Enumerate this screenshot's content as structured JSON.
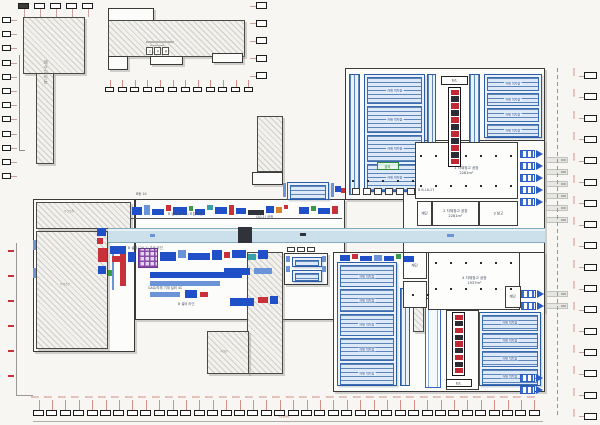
{
  "drawing": {
    "type": "factory-floorplan",
    "sheet_bg": "#f7f6f3"
  },
  "palette": {
    "B": "#2050c8",
    "b": "#6a93d8",
    "R": "#c8303a",
    "G": "#3a9a4a",
    "T": "#38a0a8",
    "D": "#30343a",
    "O": "#d8822f",
    "W": "#ffffff",
    "grayline": "#b8b8b2"
  },
  "labels": {
    "dim": "8000",
    "dim_total": "72000",
    "elevator": "E/L",
    "top_center_code": "208"
  },
  "buildings": [
    {
      "cls": "hatch",
      "x": 23,
      "y": 17,
      "w": 62,
      "h": 57
    },
    {
      "cls": "hatch",
      "x": 36,
      "y": 73,
      "w": 18,
      "h": 91
    },
    {
      "cls": "bldg",
      "x": 108,
      "y": 8,
      "w": 46,
      "h": 13
    },
    {
      "cls": "hatch",
      "x": 108,
      "y": 20,
      "w": 137,
      "h": 37
    },
    {
      "cls": "bldg",
      "x": 108,
      "y": 56,
      "w": 20,
      "h": 14
    },
    {
      "cls": "bldg",
      "x": 150,
      "y": 56,
      "w": 33,
      "h": 9
    },
    {
      "cls": "bldg",
      "x": 212,
      "y": 53,
      "w": 31,
      "h": 10
    },
    {
      "cls": "hatch",
      "x": 257,
      "y": 116,
      "w": 26,
      "h": 56
    },
    {
      "cls": "bldg",
      "x": 252,
      "y": 172,
      "w": 31,
      "h": 13
    },
    {
      "cls": "bldg",
      "x": 33,
      "y": 199,
      "w": 102,
      "h": 153
    },
    {
      "cls": "hatch",
      "x": 36,
      "y": 202,
      "w": 95,
      "h": 27
    },
    {
      "cls": "hatch",
      "x": 36,
      "y": 231,
      "w": 72,
      "h": 118
    },
    {
      "cls": "bldg",
      "x": 135,
      "y": 199,
      "w": 210,
      "h": 121
    },
    {
      "cls": "bldg",
      "x": 345,
      "y": 68,
      "w": 200,
      "h": 132
    },
    {
      "cls": "bldg",
      "x": 403,
      "y": 140,
      "w": 142,
      "h": 172
    },
    {
      "cls": "bldg",
      "x": 333,
      "y": 252,
      "w": 212,
      "h": 140
    },
    {
      "cls": "hatch",
      "x": 247,
      "y": 252,
      "w": 36,
      "h": 122
    },
    {
      "cls": "hatch",
      "x": 207,
      "y": 331,
      "w": 42,
      "h": 43
    },
    {
      "cls": "bldg",
      "x": 284,
      "y": 253,
      "w": 44,
      "h": 32
    },
    {
      "cls": "hatch",
      "x": 413,
      "y": 300,
      "w": 11,
      "h": 32
    }
  ],
  "rack_areas": [
    {
      "x": 364,
      "y": 74,
      "w": 61,
      "h": 118,
      "n": 4,
      "l1": "자재 적치장",
      "l2": "363m²"
    },
    {
      "x": 484,
      "y": 74,
      "w": 58,
      "h": 64,
      "n": 4,
      "l1": "자재 적치장",
      "l2": "363m²"
    },
    {
      "x": 337,
      "y": 262,
      "w": 60,
      "h": 124,
      "n": 5,
      "l1": "자재 적치장",
      "l2": "363m²"
    },
    {
      "x": 479,
      "y": 312,
      "w": 62,
      "h": 74,
      "n": 4,
      "l1": "자재 적치장",
      "l2": "363m²"
    },
    {
      "x": 287,
      "y": 182,
      "w": 42,
      "h": 18,
      "n": 1,
      "l1": "",
      "l2": ""
    },
    {
      "x": 292,
      "y": 257,
      "w": 30,
      "h": 10,
      "n": 1,
      "l1": "",
      "l2": ""
    },
    {
      "x": 292,
      "y": 270,
      "w": 30,
      "h": 12,
      "n": 1,
      "l1": "",
      "l2": ""
    }
  ],
  "channels": [
    {
      "x": 349,
      "y": 74,
      "w": 11,
      "h": 121,
      "double": false
    },
    {
      "x": 427,
      "y": 74,
      "w": 9,
      "h": 121,
      "double": false
    },
    {
      "x": 469,
      "y": 74,
      "w": 11,
      "h": 121,
      "double": false
    },
    {
      "x": 400,
      "y": 288,
      "w": 10,
      "h": 98,
      "double": false
    },
    {
      "x": 425,
      "y": 298,
      "w": 16,
      "h": 90,
      "double": true
    }
  ],
  "rooms": [
    {
      "x": 415,
      "y": 142,
      "w": 103,
      "h": 57,
      "lines": [
        "1 자재창고 공장",
        "2281m²"
      ]
    },
    {
      "x": 417,
      "y": 201,
      "w": 15,
      "h": 25,
      "lines": [
        "계단"
      ]
    },
    {
      "x": 432,
      "y": 201,
      "w": 47,
      "h": 25,
      "lines": [
        "2 자재창고 공장",
        "2281m²"
      ]
    },
    {
      "x": 479,
      "y": 201,
      "w": 39,
      "h": 25,
      "lines": [
        "3 창고"
      ]
    },
    {
      "x": 428,
      "y": 252,
      "w": 92,
      "h": 58,
      "lines": [
        "4 자재창고 공장",
        "1937m²"
      ]
    },
    {
      "x": 403,
      "y": 252,
      "w": 24,
      "h": 27,
      "lines": [
        "계단"
      ]
    },
    {
      "x": 403,
      "y": 281,
      "w": 24,
      "h": 27,
      "lines": []
    },
    {
      "x": 505,
      "y": 286,
      "w": 16,
      "h": 22,
      "lines": [
        "계단"
      ]
    },
    {
      "x": 446,
      "y": 310,
      "w": 33,
      "h": 80,
      "lines": []
    }
  ],
  "towers": [
    {
      "x": 448,
      "y": 87,
      "w": 13,
      "h": 80,
      "cells": 11,
      "label": {
        "x": 441,
        "y": 76,
        "w": 27,
        "h": 9
      }
    },
    {
      "x": 452,
      "y": 312,
      "w": 13,
      "h": 64,
      "cells": 9,
      "label": {
        "x": 446,
        "y": 379,
        "w": 26,
        "h": 8
      }
    }
  ],
  "docks": [
    {
      "x": 520,
      "y": 150
    },
    {
      "x": 520,
      "y": 162
    },
    {
      "x": 520,
      "y": 174
    },
    {
      "x": 520,
      "y": 186
    },
    {
      "x": 520,
      "y": 198
    },
    {
      "x": 521,
      "y": 290
    },
    {
      "x": 521,
      "y": 302
    },
    {
      "x": 520,
      "y": 374
    },
    {
      "x": 520,
      "y": 386
    }
  ],
  "gray_tags": [
    {
      "x": 546,
      "y": 157
    },
    {
      "x": 546,
      "y": 169
    },
    {
      "x": 546,
      "y": 181
    },
    {
      "x": 546,
      "y": 193
    },
    {
      "x": 546,
      "y": 205
    },
    {
      "x": 546,
      "y": 217
    },
    {
      "x": 546,
      "y": 291
    },
    {
      "x": 546,
      "y": 303
    }
  ],
  "dot_rows": [
    {
      "x": 420,
      "y": 155,
      "w": 92
    },
    {
      "x": 420,
      "y": 185,
      "w": 92
    },
    {
      "x": 352,
      "y": 180,
      "w": 70
    },
    {
      "x": 435,
      "y": 262,
      "w": 80
    },
    {
      "x": 435,
      "y": 288,
      "w": 80
    },
    {
      "x": 412,
      "y": 294,
      "w": 18
    }
  ],
  "conveyor": {
    "x": 108,
    "y": 228,
    "w": 437,
    "h": 15
  },
  "machines": [
    [
      132,
      207,
      10,
      8,
      "B"
    ],
    [
      144,
      205,
      6,
      10,
      "b"
    ],
    [
      152,
      209,
      12,
      6,
      "B"
    ],
    [
      166,
      205,
      5,
      6,
      "R"
    ],
    [
      173,
      207,
      14,
      8,
      "B"
    ],
    [
      189,
      206,
      4,
      5,
      "G"
    ],
    [
      195,
      209,
      10,
      6,
      "B"
    ],
    [
      207,
      205,
      6,
      5,
      "T"
    ],
    [
      215,
      207,
      12,
      7,
      "B"
    ],
    [
      229,
      205,
      5,
      10,
      "R"
    ],
    [
      236,
      208,
      10,
      6,
      "B"
    ],
    [
      248,
      210,
      16,
      5,
      "D"
    ],
    [
      266,
      206,
      8,
      7,
      "B"
    ],
    [
      276,
      207,
      6,
      6,
      "O"
    ],
    [
      284,
      205,
      4,
      4,
      "R"
    ],
    [
      299,
      207,
      10,
      7,
      "B"
    ],
    [
      311,
      206,
      5,
      5,
      "G"
    ],
    [
      318,
      208,
      12,
      6,
      "B"
    ],
    [
      332,
      206,
      6,
      8,
      "R"
    ],
    [
      283,
      183,
      3,
      14,
      "b"
    ],
    [
      331,
      183,
      3,
      14,
      "b"
    ],
    [
      335,
      186,
      6,
      6,
      "B"
    ],
    [
      341,
      188,
      4,
      5,
      "R"
    ],
    [
      138,
      248,
      20,
      20,
      "grid"
    ],
    [
      120,
      250,
      6,
      36,
      "R"
    ],
    [
      128,
      252,
      7,
      10,
      "B"
    ],
    [
      160,
      252,
      16,
      9,
      "B"
    ],
    [
      178,
      250,
      8,
      8,
      "b"
    ],
    [
      188,
      253,
      22,
      7,
      "B"
    ],
    [
      212,
      250,
      10,
      10,
      "B"
    ],
    [
      224,
      252,
      6,
      6,
      "R"
    ],
    [
      232,
      250,
      14,
      8,
      "B"
    ],
    [
      248,
      254,
      8,
      6,
      "T"
    ],
    [
      258,
      250,
      10,
      9,
      "B"
    ],
    [
      150,
      272,
      92,
      6,
      "B"
    ],
    [
      150,
      281,
      70,
      5,
      "b"
    ],
    [
      98,
      248,
      9,
      14,
      "R"
    ],
    [
      98,
      266,
      8,
      8,
      "B"
    ],
    [
      108,
      270,
      6,
      6,
      "G"
    ],
    [
      224,
      268,
      26,
      7,
      "B"
    ],
    [
      254,
      268,
      18,
      6,
      "b"
    ],
    [
      150,
      292,
      30,
      5,
      "b"
    ],
    [
      185,
      290,
      12,
      8,
      "B"
    ],
    [
      200,
      292,
      8,
      5,
      "R"
    ],
    [
      230,
      298,
      24,
      8,
      "B"
    ],
    [
      258,
      297,
      10,
      6,
      "R"
    ],
    [
      270,
      296,
      8,
      8,
      "B"
    ],
    [
      112,
      246,
      2,
      44,
      "b"
    ],
    [
      110,
      246,
      16,
      8,
      "B"
    ],
    [
      112,
      256,
      10,
      6,
      "R"
    ],
    [
      97,
      228,
      9,
      8,
      "B"
    ],
    [
      97,
      238,
      6,
      6,
      "R"
    ],
    [
      340,
      255,
      10,
      6,
      "B"
    ],
    [
      352,
      254,
      6,
      5,
      "R"
    ],
    [
      360,
      256,
      12,
      5,
      "B"
    ],
    [
      374,
      255,
      8,
      6,
      "b"
    ],
    [
      384,
      256,
      10,
      5,
      "B"
    ],
    [
      396,
      254,
      5,
      5,
      "G"
    ],
    [
      404,
      256,
      10,
      6,
      "B"
    ],
    [
      238,
      227,
      14,
      16,
      "D"
    ],
    [
      300,
      233,
      6,
      3,
      "D"
    ],
    [
      447,
      234,
      7,
      3,
      "b"
    ],
    [
      150,
      234,
      5,
      3,
      "b"
    ],
    [
      33,
      240,
      3,
      10,
      "b"
    ],
    [
      33,
      268,
      3,
      10,
      "b"
    ],
    [
      352,
      188,
      8,
      7,
      "W"
    ],
    [
      363,
      188,
      8,
      7,
      "W"
    ],
    [
      374,
      188,
      8,
      7,
      "W"
    ],
    [
      385,
      188,
      8,
      7,
      "W"
    ],
    [
      396,
      188,
      8,
      7,
      "W"
    ],
    [
      407,
      188,
      8,
      7,
      "W"
    ],
    [
      287,
      247,
      8,
      5,
      "W"
    ],
    [
      297,
      247,
      8,
      5,
      "W"
    ],
    [
      307,
      247,
      8,
      5,
      "W"
    ],
    [
      286,
      256,
      4,
      6,
      "b"
    ],
    [
      286,
      266,
      4,
      6,
      "b"
    ],
    [
      322,
      256,
      4,
      6,
      "b"
    ],
    [
      322,
      266,
      4,
      6,
      "b"
    ],
    [
      146,
      41,
      28,
      2,
      "grayline"
    ],
    [
      150,
      45,
      14,
      1,
      "grayline"
    ],
    [
      8,
      250,
      6,
      2,
      "R"
    ],
    [
      8,
      275,
      6,
      2,
      "R"
    ],
    [
      8,
      300,
      6,
      2,
      "R"
    ],
    [
      8,
      325,
      6,
      2,
      "R"
    ],
    [
      8,
      350,
      6,
      2,
      "R"
    ],
    [
      8,
      375,
      6,
      2,
      "R"
    ]
  ],
  "lines": [
    {
      "x": 19,
      "y": 55,
      "w": 1,
      "h": 96,
      "c": "#8a8a86"
    },
    {
      "x": 19,
      "y": 150,
      "w": 6,
      "h": 1,
      "c": "#8a8a86"
    },
    {
      "x": 16,
      "y": 243,
      "w": 1,
      "h": 153,
      "c": "#9a9a94"
    },
    {
      "x": 16,
      "y": 395,
      "w": 17,
      "h": 1,
      "c": "#9a9a94"
    },
    {
      "x": 33,
      "y": 421,
      "w": 510,
      "h": 1,
      "c": "#b0aca6"
    },
    {
      "x": 557,
      "y": 68,
      "w": 1,
      "h": 348,
      "c": "#d08070",
      "dashed": true
    },
    {
      "x": 130,
      "y": 218,
      "w": 212,
      "h": 1,
      "c": "#50545a"
    }
  ],
  "green_tag": {
    "x": 377,
    "y": 162,
    "w": 22,
    "h": 8,
    "text": "출하"
  },
  "code_pos": {
    "x": 146,
    "y": 47,
    "w": 7,
    "h": 8,
    "gap": 1
  },
  "texts": [
    {
      "x": 42,
      "y": 60,
      "s": 0.8,
      "c": "tg",
      "vert": true,
      "text": "폐수처리동"
    },
    {
      "x": 64,
      "y": 210,
      "s": 0.6,
      "c": "tg",
      "text": "Y-555"
    },
    {
      "x": 60,
      "y": 283,
      "s": 0.6,
      "c": "tg",
      "text": "Y-557"
    },
    {
      "x": 220,
      "y": 350,
      "s": 0.6,
      "c": "tg",
      "text": "+50"
    },
    {
      "x": 168,
      "y": 213,
      "s": 0.55,
      "c": "td",
      "text": "B 설비 (20-1) 조립 라인"
    },
    {
      "x": 256,
      "y": 216,
      "s": 0.55,
      "c": "td",
      "text": "(20-1) 공정"
    },
    {
      "x": 128,
      "y": 247,
      "s": 0.55,
      "c": "td",
      "text": "B 설비 (20-1) 가공 라인"
    },
    {
      "x": 148,
      "y": 287,
      "s": 0.55,
      "c": "td",
      "text": "GAD/자체 기계 설비 4C"
    },
    {
      "x": 178,
      "y": 303,
      "s": 0.55,
      "c": "td",
      "text": "B 설비 라인"
    },
    {
      "x": 418,
      "y": 189,
      "s": 0.55,
      "c": "td",
      "text": "B B-18-27"
    },
    {
      "x": 136,
      "y": 193,
      "s": 0.55,
      "c": "td",
      "text": "B동 10"
    },
    {
      "x": 278,
      "y": 415,
      "s": 0.6,
      "c": "tr",
      "text": "72000"
    }
  ],
  "callout_rows": [
    {
      "name": "top-left-row",
      "dir": "h",
      "x": 18,
      "y": 3,
      "step": 16,
      "count": 5,
      "bw": 11,
      "bh": 6,
      "leader": "down",
      "llen": 8,
      "first_filled": true,
      "tick": false
    },
    {
      "name": "left-column",
      "dir": "v",
      "x": 2,
      "y": 17,
      "step": 14.2,
      "count": 12,
      "bw": 9,
      "bh": 6,
      "leader": "right",
      "llen": 6,
      "tick": false
    },
    {
      "name": "mid-row",
      "dir": "h",
      "x": 105,
      "y": 87,
      "step": 12.6,
      "count": 12,
      "bw": 9,
      "bh": 5,
      "leader": "up",
      "llen": 7,
      "tick": false,
      "red_leader": true
    },
    {
      "name": "center-column",
      "dir": "v",
      "x": 256,
      "y": 2,
      "step": 17.5,
      "count": 5,
      "bw": 11,
      "bh": 7,
      "leader": "left",
      "llen": 6,
      "tick": false
    },
    {
      "name": "right-column",
      "dir": "v",
      "x": 584,
      "y": 72,
      "step": 21.3,
      "count": 17,
      "bw": 13,
      "bh": 7,
      "leader": "left",
      "llen": 5,
      "tick": true,
      "tick_mode": "vertical"
    },
    {
      "name": "bottom-row",
      "dir": "h",
      "x": 33,
      "y": 410,
      "step": 13.4,
      "count": 38,
      "bw": 11,
      "bh": 6,
      "leader": "up",
      "llen": 10,
      "tick": true,
      "tick_mode": "above",
      "red_leader": true
    }
  ]
}
